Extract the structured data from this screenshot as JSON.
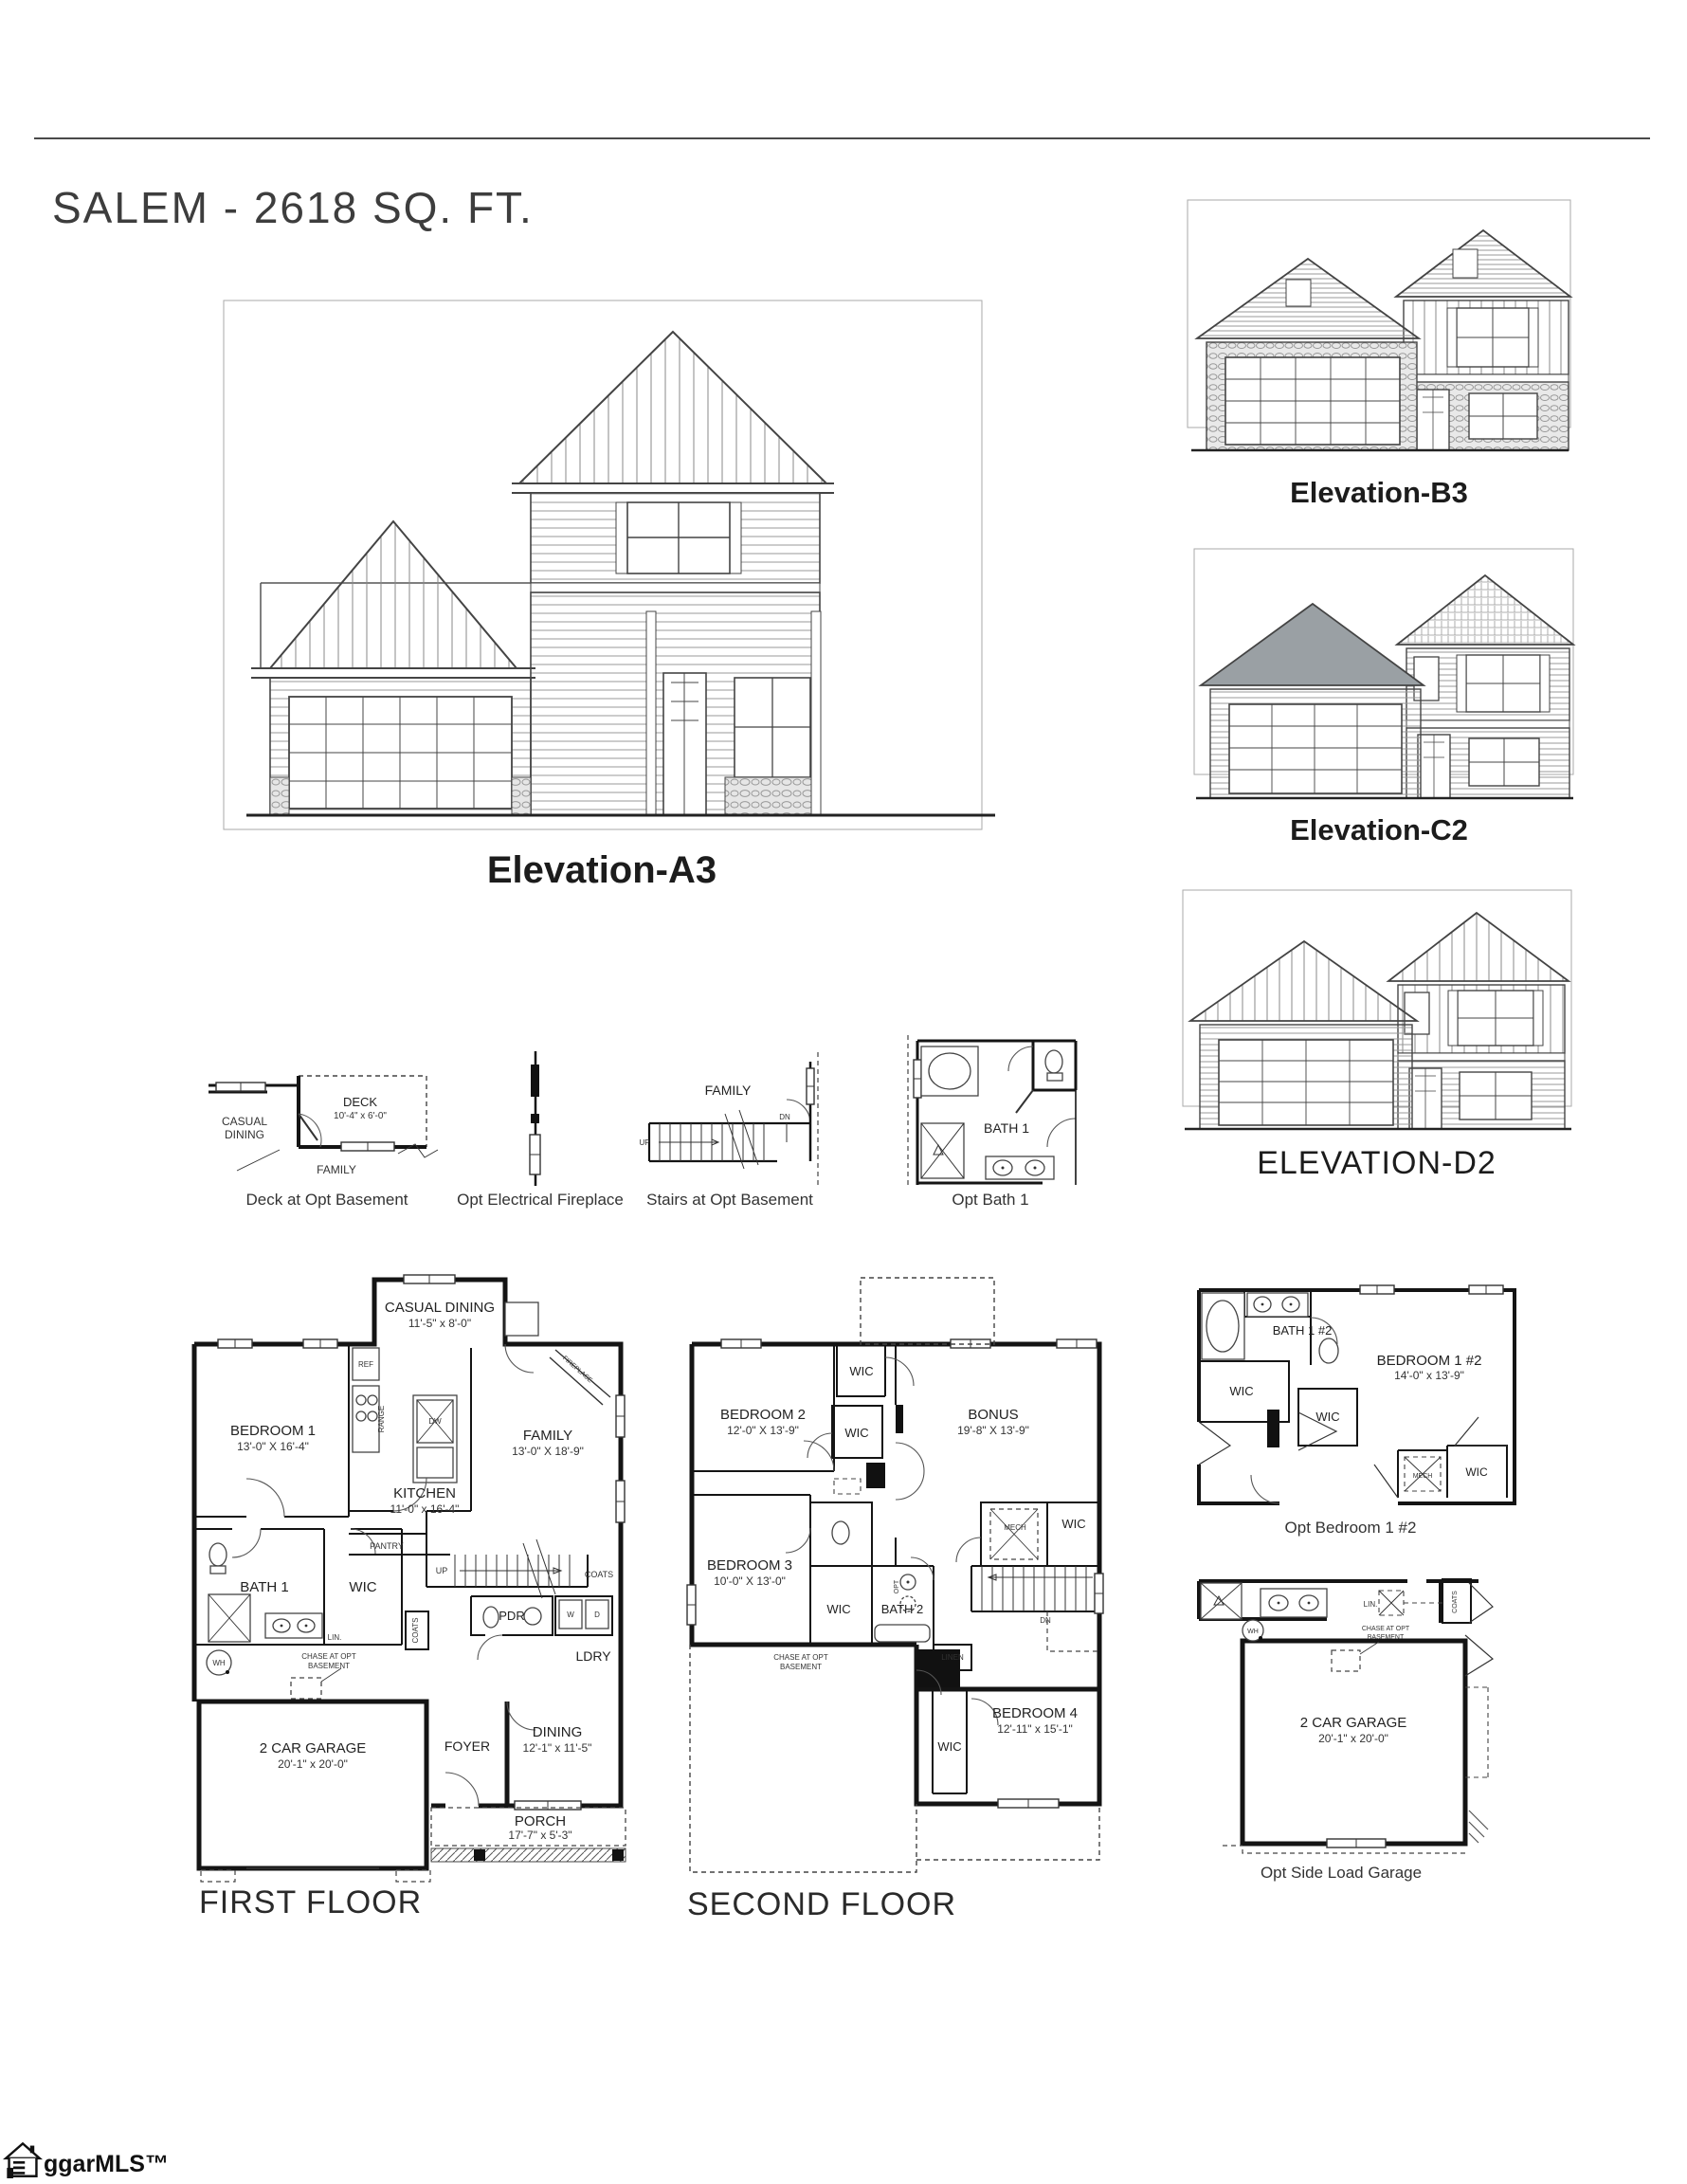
{
  "page": {
    "title": "SALEM - 2618 SQ. FT.",
    "watermark": "ggarMLS™"
  },
  "elevations": {
    "a3_label": "Elevation-A3",
    "b3_label": "Elevation-B3",
    "c2_label": "Elevation-C2",
    "d2_label": "ELEVATION-D2"
  },
  "options": {
    "deck": {
      "room": "DECK",
      "room_dims": "10'-4\" x 6'-0\"",
      "casual_line1": "CASUAL",
      "casual_line2": "DINING",
      "family": "FAMILY",
      "caption": "Deck at Opt Basement"
    },
    "fireplace": {
      "caption": "Opt Electrical Fireplace"
    },
    "stairs": {
      "family": "FAMILY",
      "up": "UP",
      "dn": "DN",
      "caption": "Stairs at Opt Basement"
    },
    "bath": {
      "room": "BATH 1",
      "caption": "Opt Bath 1"
    }
  },
  "first_floor": {
    "caption": "FIRST FLOOR",
    "casual_dining": "CASUAL DINING",
    "casual_dining_dims": "11'-5\" x 8'-0\"",
    "bedroom1": "BEDROOM 1",
    "bedroom1_dims": "13'-0\" X 16'-4\"",
    "family": "FAMILY",
    "family_dims": "13'-0\" X 18'-9\"",
    "kitchen": "KITCHEN",
    "kitchen_dims": "11'-0\" x 16'-4\"",
    "ref": "REF",
    "range": "RANGE",
    "dw": "DW",
    "fireplace": "FIREPLACE",
    "pantry": "PANTRY",
    "bath1": "BATH 1",
    "wic": "WIC",
    "lin": "LIN.",
    "coats_closet": "COATS",
    "up": "UP",
    "pdr": "PDR",
    "coats": "COATS",
    "w": "W",
    "d": "D",
    "ldry": "LDRY",
    "wh": "WH",
    "chase_line1": "CHASE AT OPT",
    "chase_line2": "BASEMENT",
    "garage": "2 CAR GARAGE",
    "garage_dims": "20'-1\" x 20'-0\"",
    "foyer": "FOYER",
    "dining": "DINING",
    "dining_dims": "12'-1\" x 11'-5\"",
    "porch": "PORCH",
    "porch_dims": "17'-7\" x 5'-3\""
  },
  "second_floor": {
    "caption": "SECOND FLOOR",
    "bedroom2": "BEDROOM 2",
    "bedroom2_dims": "12'-0\" X 13'-9\"",
    "wic1": "WIC",
    "wic2": "WIC",
    "bonus": "BONUS",
    "bonus_dims": "19'-8\" X 13'-9\"",
    "bedroom3": "BEDROOM 3",
    "bedroom3_dims": "10'-0\" X 13'-0\"",
    "wic3": "WIC",
    "bath2": "BATH 2",
    "opt": "OPT",
    "mech": "MECH",
    "wic4": "WIC",
    "dn": "DN",
    "linen": "LINEN",
    "chase_line1": "CHASE AT OPT",
    "chase_line2": "BASEMENT",
    "bedroom4": "BEDROOM 4",
    "bedroom4_dims": "12'-11\" x 15'-1\"",
    "wic5": "WIC"
  },
  "opt_bedroom": {
    "caption": "Opt Bedroom 1 #2",
    "bath": "BATH 1 #2",
    "wic1": "WIC",
    "bedroom": "BEDROOM 1 #2",
    "bedroom_dims": "14'-0\" x 13'-9\"",
    "wic2": "WIC",
    "mech": "MECH",
    "wic3": "WIC"
  },
  "opt_garage": {
    "caption": "Opt Side Load Garage",
    "lin": "LIN.",
    "coats": "COATS",
    "wh": "WH",
    "chase_line1": "CHASE AT OPT",
    "chase_line2": "BASEMENT",
    "garage": "2 CAR GARAGE",
    "garage_dims": "20'-1\" x 20'-0\""
  }
}
